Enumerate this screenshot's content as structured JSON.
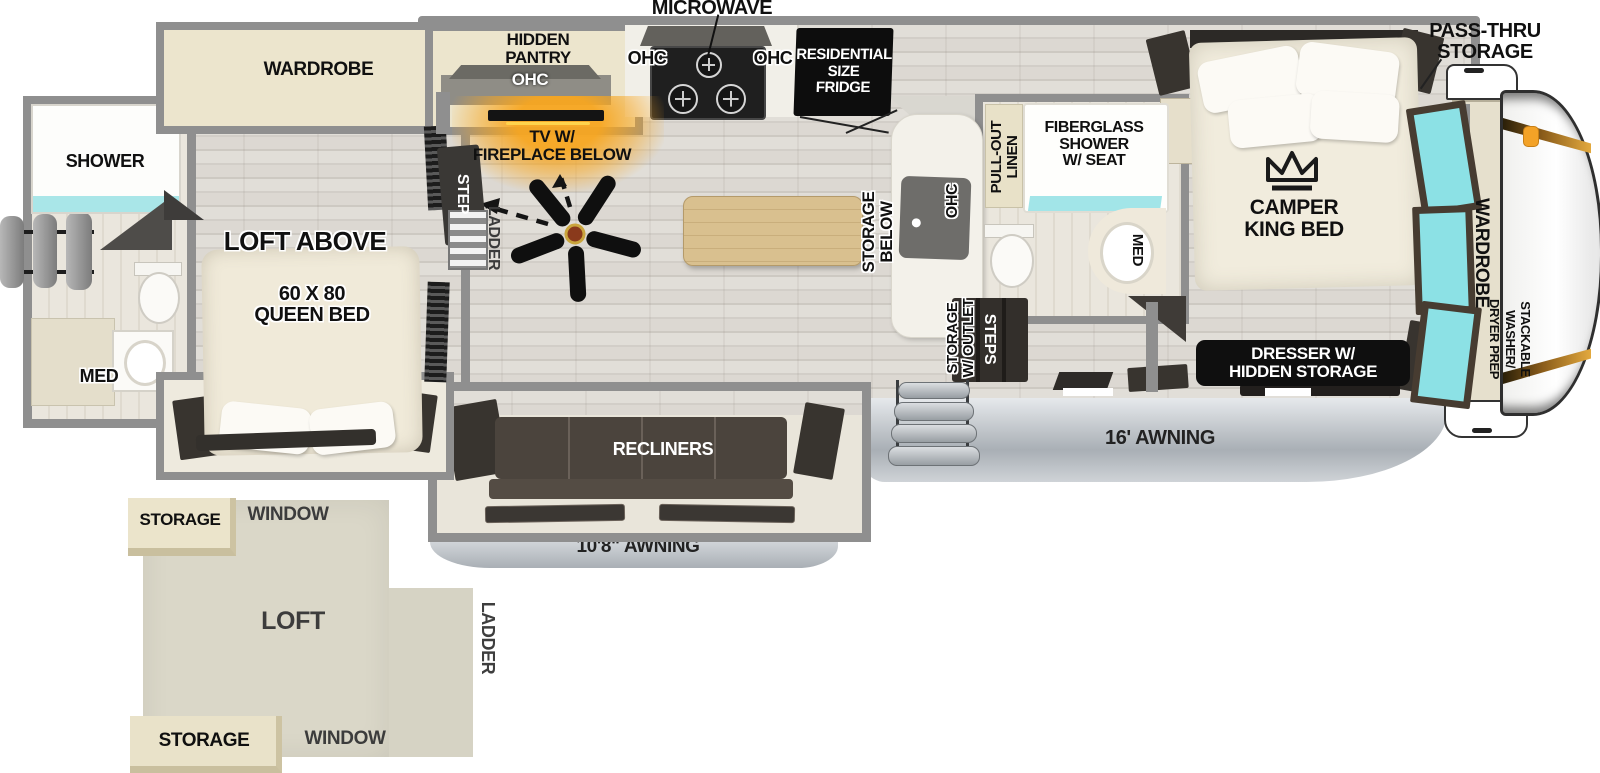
{
  "diagram_type": "rv-fifth-wheel-floorplan-top-view",
  "labels": {
    "microwave": "MICROWAVE",
    "ohc": "OHC",
    "hidden_pantry": "HIDDEN\nPANTRY",
    "fridge": "RESIDENTIAL\nSIZE\nFRIDGE",
    "pass_thru": "PASS-THRU\nSTORAGE",
    "tv_fireplace": "TV W/\nFIREPLACE BELOW",
    "step": "STEP",
    "ladder": "LADDER",
    "storage_below": "STORAGE\nBELOW",
    "pull_out_linen": "PULL-OUT\nLINEN",
    "fiberglass_shower": "FIBERGLASS\nSHOWER\nW/ SEAT",
    "med": "MED",
    "steps": "STEPS",
    "storage_outlet": "STORAGE\nW/ OUTLET",
    "camper_king_bed": "CAMPER\nKING BED",
    "wardrobe": "WARDROBE",
    "stackable_washer": "STACKABLE WASHER/\nDRYER PREP",
    "dresser": "DRESSER W/\nHIDDEN STORAGE",
    "awning_16": "16' AWNING",
    "recliners": "RECLINERS",
    "awning_10_8": "10'8\" AWNING",
    "shower": "SHOWER",
    "loft_above": "LOFT ABOVE",
    "queen_bed": "60 X 80\nQUEEN BED",
    "loft": "LOFT",
    "window": "WINDOW",
    "storage": "STORAGE"
  },
  "colors": {
    "wall": "#8f8f8f",
    "beige": "#ece5cd",
    "teal": "#8ce1e5",
    "orange": "#f3a227",
    "black_box": "#0d0d0d",
    "recliner": "#4b443d",
    "awning_light": "#e6e9ec",
    "awning_dark": "#a9afb5",
    "loft_bg": "#dad7c8",
    "wood_floor": "#d8d5cf"
  }
}
